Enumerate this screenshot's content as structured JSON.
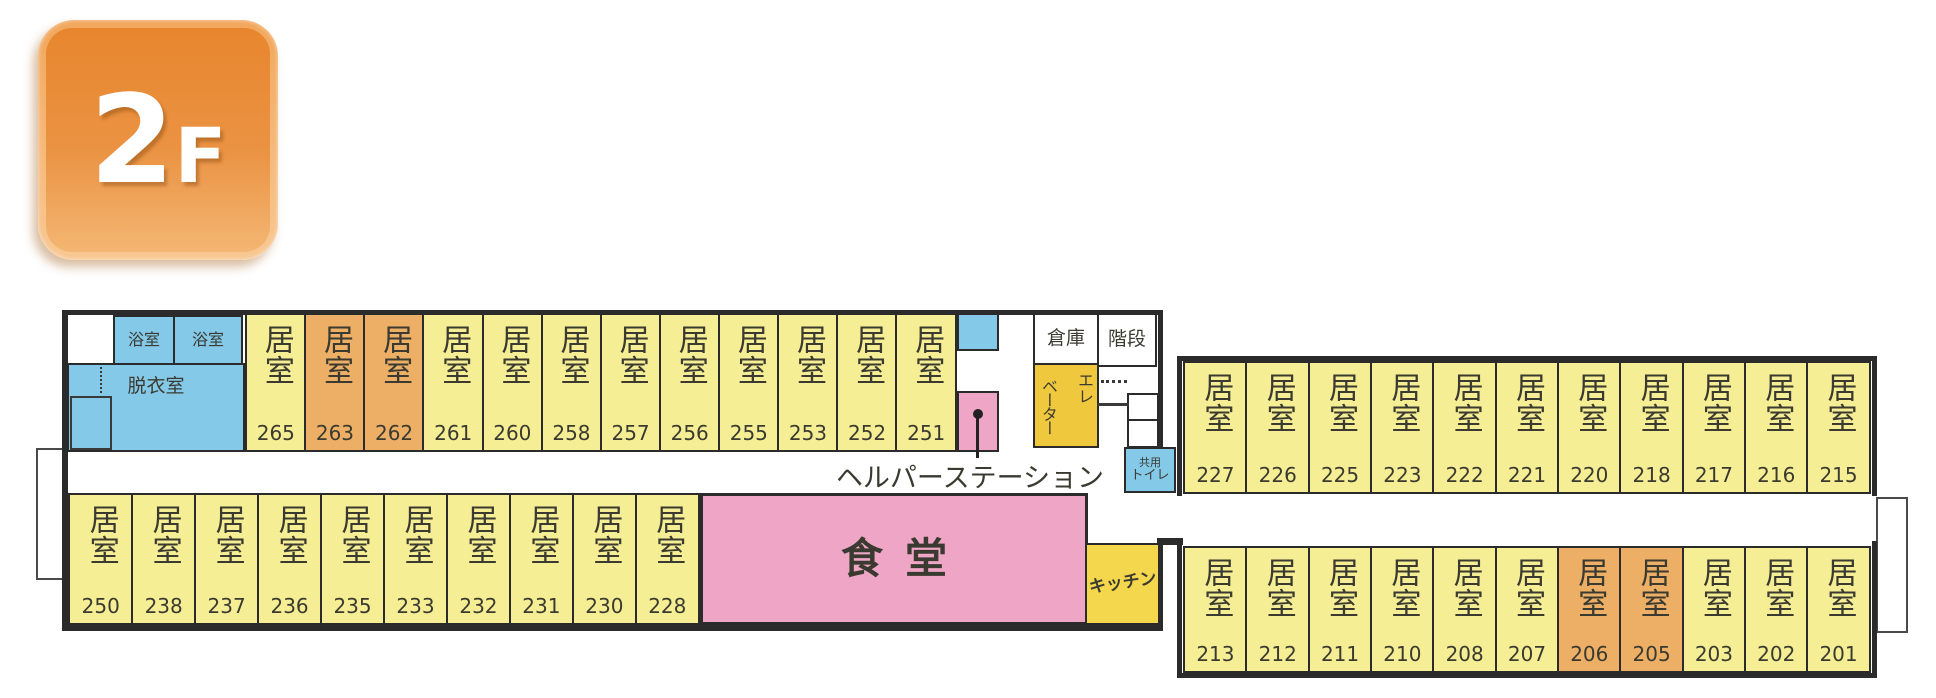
{
  "page": {
    "type": "floor-plan",
    "floor_name": "2F"
  },
  "badge": {
    "number": "2",
    "suffix": "F"
  },
  "labels": {
    "room": "居室",
    "bath_left": "浴室",
    "bath_right": "浴室",
    "dressing_room": "脱衣室",
    "storage": "倉庫",
    "stairs": "階段",
    "elevator": "エレベーター",
    "helper_station": "ヘルパーステーション",
    "shared_toilet_line1": "共用",
    "shared_toilet_line2": "トイレ",
    "dining_hall": "食堂",
    "kitchen": "キッチン"
  },
  "rooms": {
    "top_left_wing": [
      {
        "number": "265",
        "variant": "yellow"
      },
      {
        "number": "263",
        "variant": "orange"
      },
      {
        "number": "262",
        "variant": "orange"
      },
      {
        "number": "261",
        "variant": "yellow"
      },
      {
        "number": "260",
        "variant": "yellow"
      },
      {
        "number": "258",
        "variant": "yellow"
      },
      {
        "number": "257",
        "variant": "yellow"
      },
      {
        "number": "256",
        "variant": "yellow"
      },
      {
        "number": "255",
        "variant": "yellow"
      },
      {
        "number": "253",
        "variant": "yellow"
      },
      {
        "number": "252",
        "variant": "yellow"
      },
      {
        "number": "251",
        "variant": "yellow"
      }
    ],
    "bottom_left_wing": [
      {
        "number": "250",
        "variant": "yellow"
      },
      {
        "number": "238",
        "variant": "yellow"
      },
      {
        "number": "237",
        "variant": "yellow"
      },
      {
        "number": "236",
        "variant": "yellow"
      },
      {
        "number": "235",
        "variant": "yellow"
      },
      {
        "number": "233",
        "variant": "yellow"
      },
      {
        "number": "232",
        "variant": "yellow"
      },
      {
        "number": "231",
        "variant": "yellow"
      },
      {
        "number": "230",
        "variant": "yellow"
      },
      {
        "number": "228",
        "variant": "yellow"
      }
    ],
    "top_right_wing": [
      {
        "number": "227",
        "variant": "yellow"
      },
      {
        "number": "226",
        "variant": "yellow"
      },
      {
        "number": "225",
        "variant": "yellow"
      },
      {
        "number": "223",
        "variant": "yellow"
      },
      {
        "number": "222",
        "variant": "yellow"
      },
      {
        "number": "221",
        "variant": "yellow"
      },
      {
        "number": "220",
        "variant": "yellow"
      },
      {
        "number": "218",
        "variant": "yellow"
      },
      {
        "number": "217",
        "variant": "yellow"
      },
      {
        "number": "216",
        "variant": "yellow"
      },
      {
        "number": "215",
        "variant": "yellow"
      }
    ],
    "bottom_right_wing": [
      {
        "number": "213",
        "variant": "yellow"
      },
      {
        "number": "212",
        "variant": "yellow"
      },
      {
        "number": "211",
        "variant": "yellow"
      },
      {
        "number": "210",
        "variant": "yellow"
      },
      {
        "number": "208",
        "variant": "yellow"
      },
      {
        "number": "207",
        "variant": "yellow"
      },
      {
        "number": "206",
        "variant": "orange"
      },
      {
        "number": "205",
        "variant": "orange"
      },
      {
        "number": "203",
        "variant": "yellow"
      },
      {
        "number": "202",
        "variant": "yellow"
      },
      {
        "number": "201",
        "variant": "yellow"
      }
    ]
  },
  "colors": {
    "room_yellow": "#F5EE94",
    "room_orange": "#EDAF66",
    "water_blue": "#85C9E9",
    "accent_pink": "#EFA6C6",
    "elevator_gold": "#F0C83E",
    "kitchen_gold": "#F4D74D",
    "outline": "#2B2B2B",
    "badge_orange": "#EA8F3C"
  }
}
